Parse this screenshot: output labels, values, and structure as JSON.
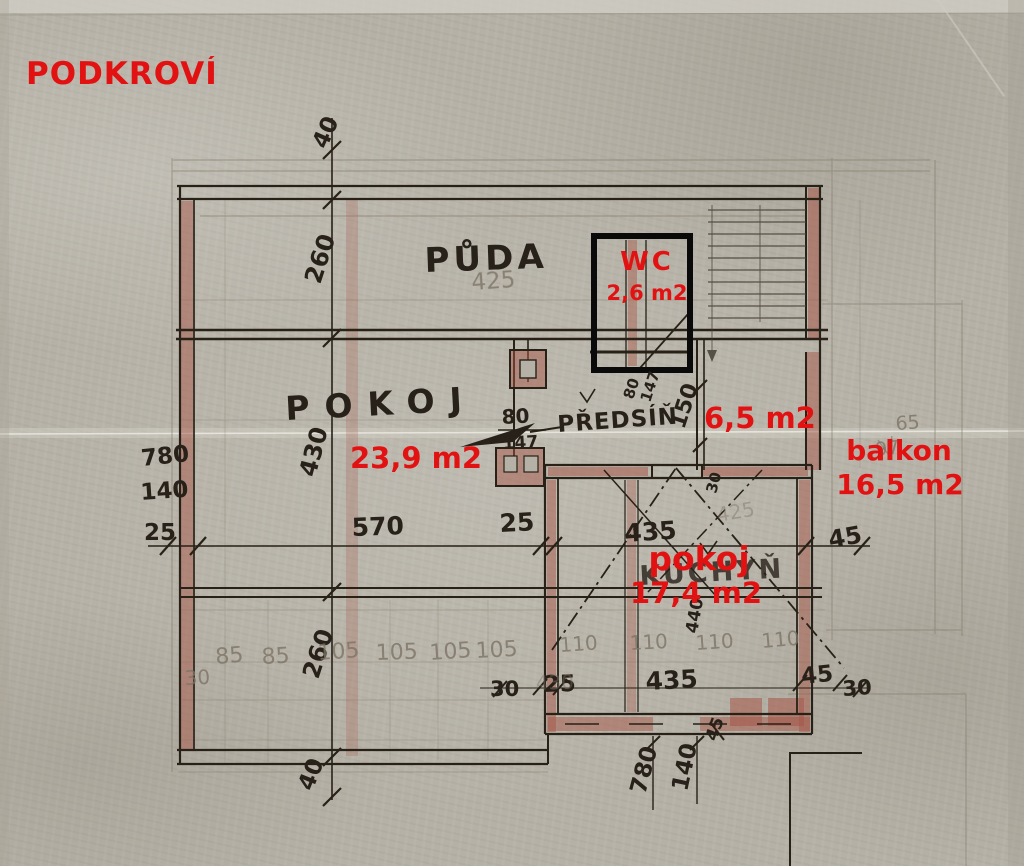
{
  "title": "PODKROVÍ",
  "colors": {
    "annotation_red": "#e31212",
    "ink": "#27211a",
    "pencil": "#877e6d",
    "wall_red": "#a65848",
    "paper": "#b5b1a6"
  },
  "rooms": {
    "puda": {
      "label": "PŮDA"
    },
    "wc": {
      "label": "WC",
      "area": "2,6 m2"
    },
    "pokoj": {
      "label": "POKOJ",
      "area": "23,9 m2"
    },
    "predsin": {
      "label": "PŘEDSÍŇ",
      "area": "6,5 m2"
    },
    "balkon": {
      "label": "balkon",
      "area": "16,5 m2"
    },
    "pokoj2": {
      "label": "pokoj",
      "area": "17,4 m2",
      "underlying_label": "KUCHYŇ"
    }
  },
  "dims": {
    "left_vertical": [
      "40",
      "260",
      "430",
      "260",
      "40"
    ],
    "left_edge": [
      "780",
      "140",
      "25"
    ],
    "mid_row": [
      "570",
      "25",
      "435",
      "45"
    ],
    "pencil_top": "425",
    "pencil_row": [
      "30",
      "85",
      "85",
      "105",
      "105",
      "105",
      "105"
    ],
    "pencil_row2": [
      "110",
      "110",
      "110",
      "110"
    ],
    "ink_bottom_row": [
      "30",
      "25",
      "435",
      "45",
      "30"
    ],
    "bottom_vertical": [
      "780",
      "140",
      "45"
    ],
    "door": {
      "w": "80",
      "h": "147"
    },
    "door_vert": [
      "80",
      "147"
    ],
    "predsin_width": "150",
    "rot_30": "30",
    "rot_440": "440",
    "pencil_faint": [
      "430",
      "425"
    ],
    "balkon_pencil": [
      "65",
      "97"
    ]
  }
}
